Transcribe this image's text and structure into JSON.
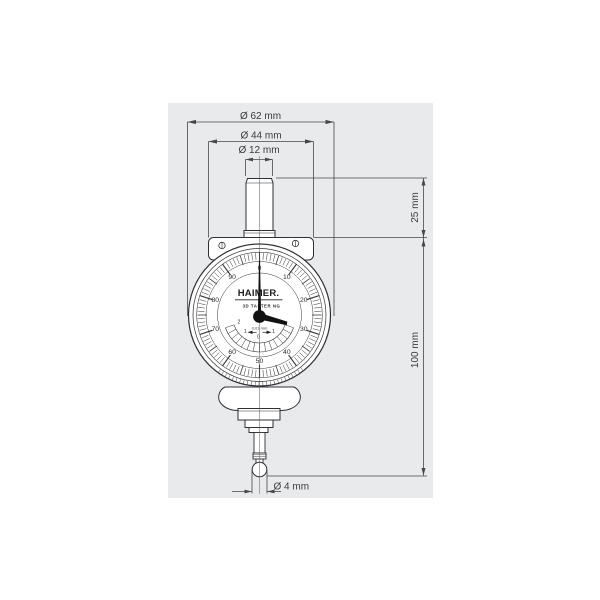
{
  "colors": {
    "page_bg": "#ffffff",
    "panel_bg": "#e8eaec",
    "dim_stroke": "#46474b",
    "device_stroke": "#2f3034",
    "needle": "#121212",
    "text": "#3a3b3e"
  },
  "dimensions": {
    "dia62": "Ø 62 mm",
    "dia44": "Ø 44 mm",
    "dia12": "Ø 12 mm",
    "len25": "25 mm",
    "len100": "100 mm",
    "dia4": "Ø 4 mm"
  },
  "dial": {
    "brand": "HAIMER.",
    "model": "3D TASTER NG",
    "graduation": "0,01 mm",
    "scale_labels": [
      "0",
      "10",
      "20",
      "30",
      "40",
      "50",
      "60",
      "70",
      "80",
      "90"
    ],
    "sub_scale_labels": [
      "2",
      "1",
      "0",
      "1",
      "2"
    ]
  }
}
